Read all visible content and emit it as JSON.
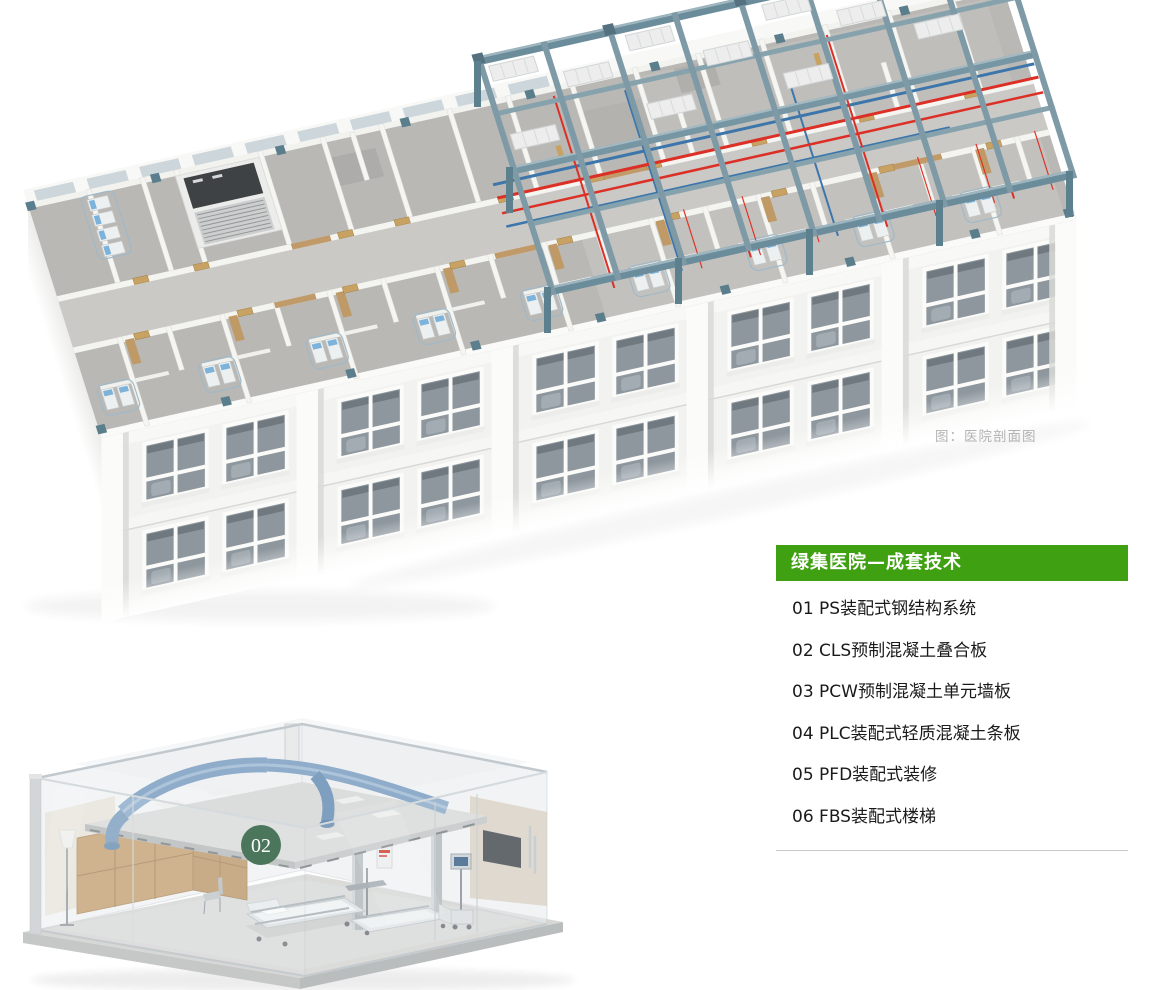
{
  "page": {
    "background": "#ffffff"
  },
  "figure_main": {
    "caption": "图：医院剖面图",
    "caption_color": "#b3b3b3"
  },
  "tech_panel": {
    "title": "绿集医院—成套技术",
    "title_color": "#ffffff",
    "title_bg": "#3fa012",
    "text_color": "#1a1a1a",
    "divider_color": "#c8c8c8",
    "items": [
      "01 PS装配式钢结构系统",
      "02 CLS预制混凝土叠合板",
      "03 PCW预制混凝土单元墙板",
      "04 PLC装配式轻质混凝土条板",
      "05 PFD装配式装修",
      "06 FBS装配式楼梯"
    ]
  },
  "figure_room": {
    "badge": "02",
    "badge_bg": "#27593a",
    "badge_text_color": "#ffffff"
  },
  "illustration_colors": {
    "steel_frame": "#7796a4",
    "red_pipe": "#dc2f26",
    "blue_pipe": "#3d76aa",
    "wood_door": "#c8a262",
    "bed_pillow": "#7db3da",
    "duct_blue": "#8fadcb",
    "facade_white": "#f2f2f0",
    "window_glass": "#8e979e",
    "floor_gray": "#b9b8b5"
  }
}
